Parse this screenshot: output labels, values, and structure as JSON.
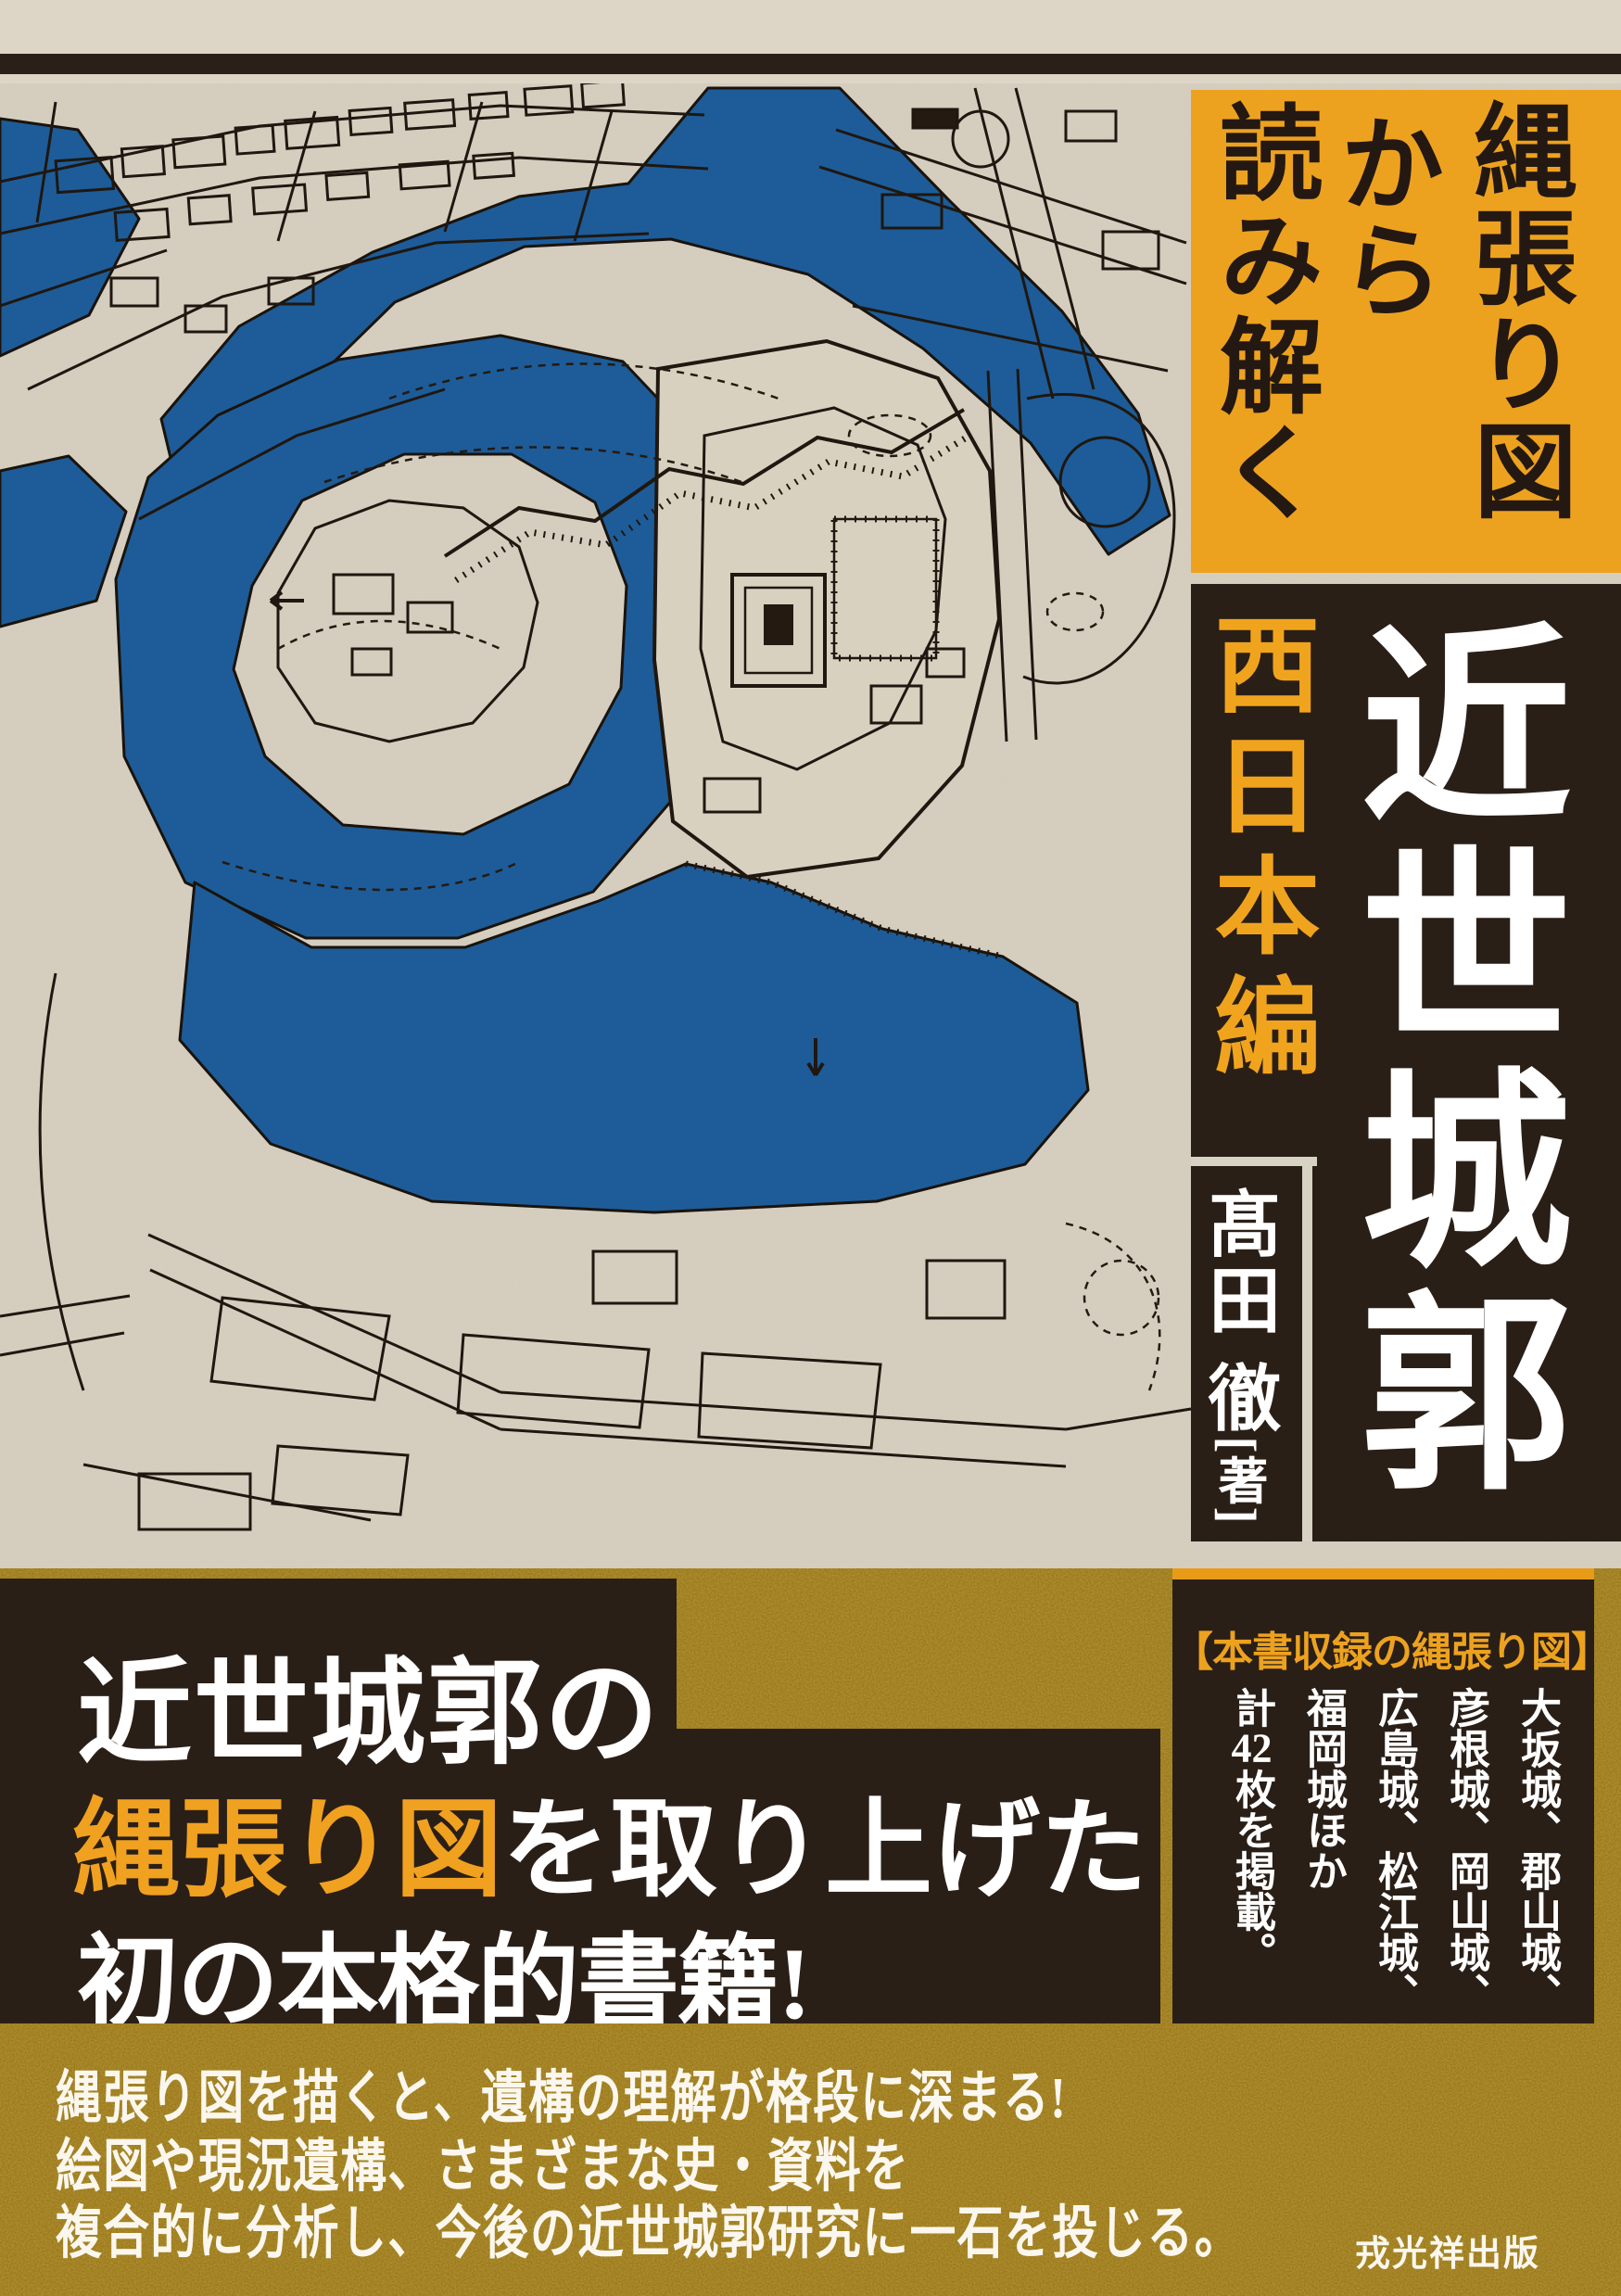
{
  "colors": {
    "accent_orange": "#eda21f",
    "panel_brown": "#2a1f17",
    "gold_band": "#967212",
    "water_blue": "#1d5c98",
    "paper": "#d7cfc0",
    "text_white": "#ffffff"
  },
  "series_box": {
    "lines": [
      "縄張り図",
      "から",
      "読み解く"
    ]
  },
  "title": {
    "main": "近世城郭",
    "edition": "西日本編"
  },
  "author": {
    "name": "髙田 徹",
    "role": "[著]"
  },
  "catch": {
    "line1": "近世城郭の",
    "line2_highlight": "縄張り図",
    "line2_rest": "を取り上げた",
    "line3": "初の本格的書籍!"
  },
  "included": {
    "header": "【本書収録の縄張り図】",
    "columns": [
      "大坂城、郡山城、",
      "彦根城、岡山城、",
      "広島城、松江城、",
      "福岡城ほか"
    ],
    "count": {
      "prefix": "計",
      "number": "42",
      "suffix": "枚を掲載。"
    }
  },
  "blurb": {
    "line1": "縄張り図を描くと、遺構の理解が格段に深まる!",
    "line2": "絵図や現況遺構、さまざまな史・資料を",
    "line3": "複合的に分析し、今後の近世城郭研究に一石を投じる。"
  },
  "publisher": "戎光祥出版"
}
